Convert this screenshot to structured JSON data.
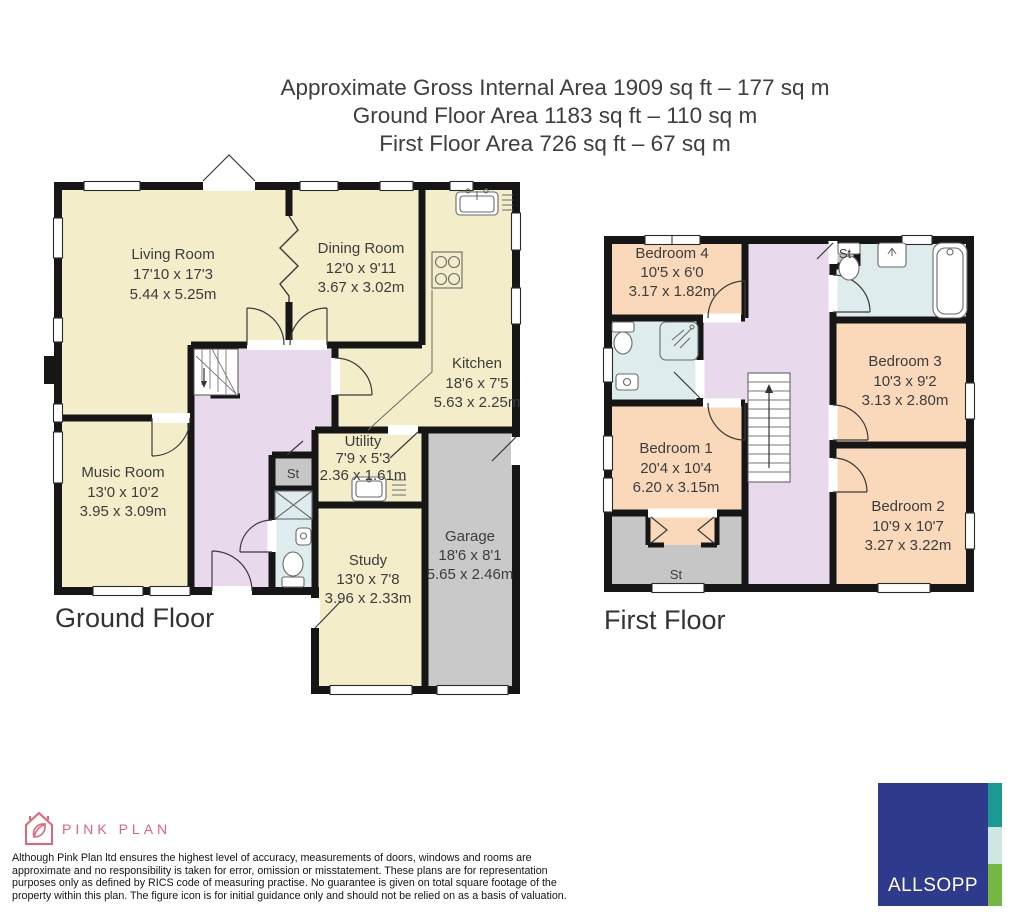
{
  "title": {
    "line1": "Approximate Gross Internal Area 1909 sq ft – 177 sq m",
    "line2": "Ground Floor Area 1183 sq ft – 110 sq m",
    "line3": "First Floor Area 726 sq ft – 67 sq m"
  },
  "ground_floor": {
    "label": "Ground Floor",
    "rooms": {
      "living_room": {
        "name": "Living Room",
        "imperial": "17'10 x 17'3",
        "metric": "5.44 x 5.25m"
      },
      "dining_room": {
        "name": "Dining Room",
        "imperial": "12'0 x 9'11",
        "metric": "3.67 x 3.02m"
      },
      "kitchen": {
        "name": "Kitchen",
        "imperial": "18'6 x 7'5",
        "metric": "5.63 x 2.25m"
      },
      "music_room": {
        "name": "Music Room",
        "imperial": "13'0 x 10'2",
        "metric": "3.95 x 3.09m"
      },
      "utility": {
        "name": "Utility",
        "imperial": "7'9 x 5'3",
        "metric": "2.36 x 1.61m"
      },
      "study": {
        "name": "Study",
        "imperial": "13'0 x 7'8",
        "metric": "3.96 x 2.33m"
      },
      "garage": {
        "name": "Garage",
        "imperial": "18'6 x 8'1",
        "metric": "5.65 x 2.46m"
      },
      "storage": {
        "name": "St"
      }
    }
  },
  "first_floor": {
    "label": "First Floor",
    "rooms": {
      "bedroom1": {
        "name": "Bedroom 1",
        "imperial": "20'4 x 10'4",
        "metric": "6.20 x 3.15m"
      },
      "bedroom2": {
        "name": "Bedroom 2",
        "imperial": "10'9 x 10'7",
        "metric": "3.27 x 3.22m"
      },
      "bedroom3": {
        "name": "Bedroom 3",
        "imperial": "10'3 x 9'2",
        "metric": "3.13 x 2.80m"
      },
      "bedroom4": {
        "name": "Bedroom 4",
        "imperial": "10'5 x 6'0",
        "metric": "3.17 x 1.82m"
      },
      "storage_bedroom1": {
        "name": "St"
      },
      "storage_bathroom": {
        "name": "St"
      }
    }
  },
  "footer": {
    "pink_plan_name": "PINK PLAN",
    "disclaimer_lines": [
      "Although Pink Plan ltd ensures the highest level of accuracy, measurements of doors, windows and rooms are",
      "approximate and no responsibility is taken for error, omission or misstatement. These plans are for representation",
      "purposes only as defined by RICS code of measuring practise. No guarantee is given on total square footage of the",
      "property within this plan. The figure icon is for initial guidance only and should not be relied on as a basis of valuation."
    ],
    "allsopp_name": "ALLSOPP"
  },
  "colors": {
    "room_cream": "#f3edca",
    "room_peach": "#f9d9ba",
    "hallway_purple": "#e8d9ec",
    "bathroom_blue": "#dfecee",
    "garage_gray": "#c9c9c9",
    "wall_black": "#161616",
    "pink_plan_pink": "#e4647a",
    "allsopp_navy": "#2e3a8c",
    "allsopp_teal": "#1b9a94",
    "allsopp_pale": "#cfe7e3",
    "allsopp_green": "#74b741"
  }
}
